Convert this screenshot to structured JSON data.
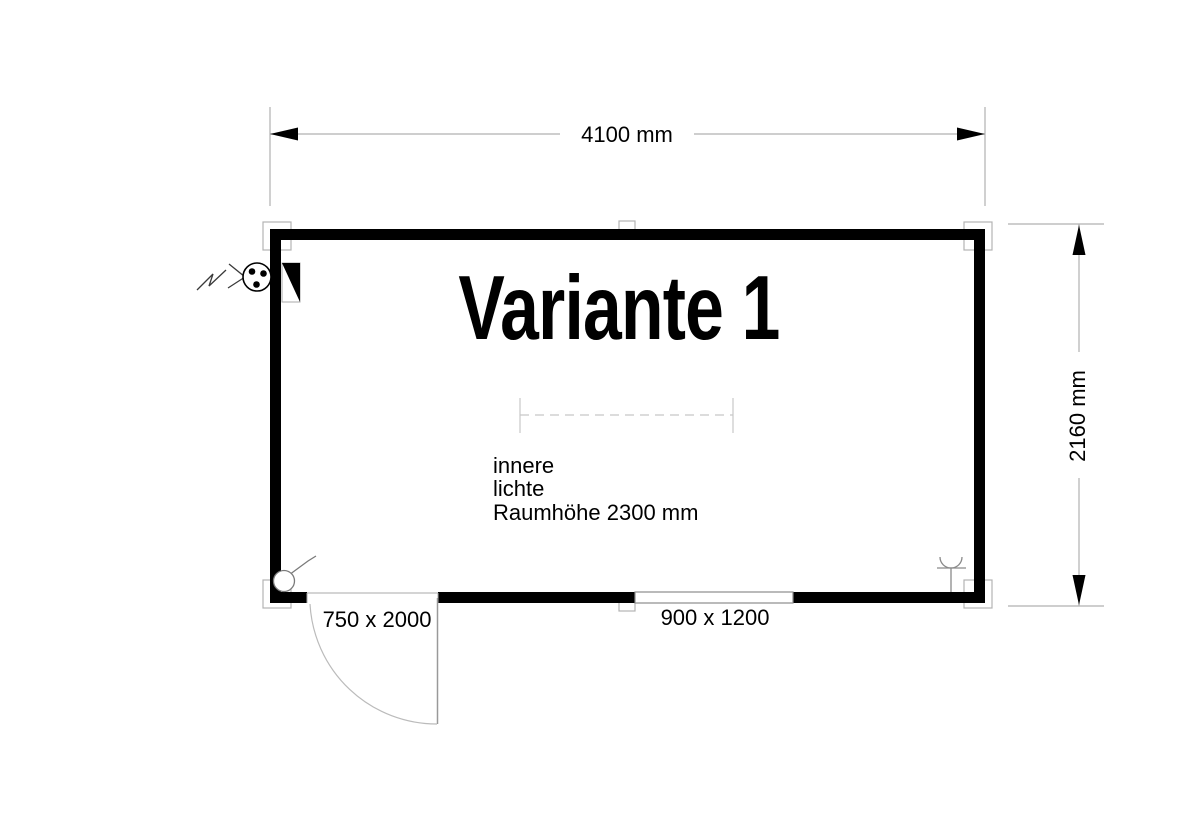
{
  "drawing": {
    "title": "Variante 1",
    "dimensions": {
      "overall_width": "4100 mm",
      "overall_depth": "2160 mm",
      "door_size": "750 x 2000",
      "window_size": "900 x 1200"
    },
    "room_note": {
      "line1": "innere",
      "line2": "lichte",
      "line3": "Raumhöhe 2300 mm"
    },
    "icons": {
      "power_feed": "power-feed-arrow-icon",
      "feed_socket": "feed-socket-icon",
      "distribution_panel": "distribution-panel-icon",
      "light_switch": "light-switch-icon",
      "wall_socket": "wall-socket-icon"
    },
    "colors": {
      "wall": "#000000",
      "line_gray": "#b0b0b0",
      "dash_gray": "#c8c8c8",
      "text": "#000000",
      "background": "#ffffff"
    }
  }
}
